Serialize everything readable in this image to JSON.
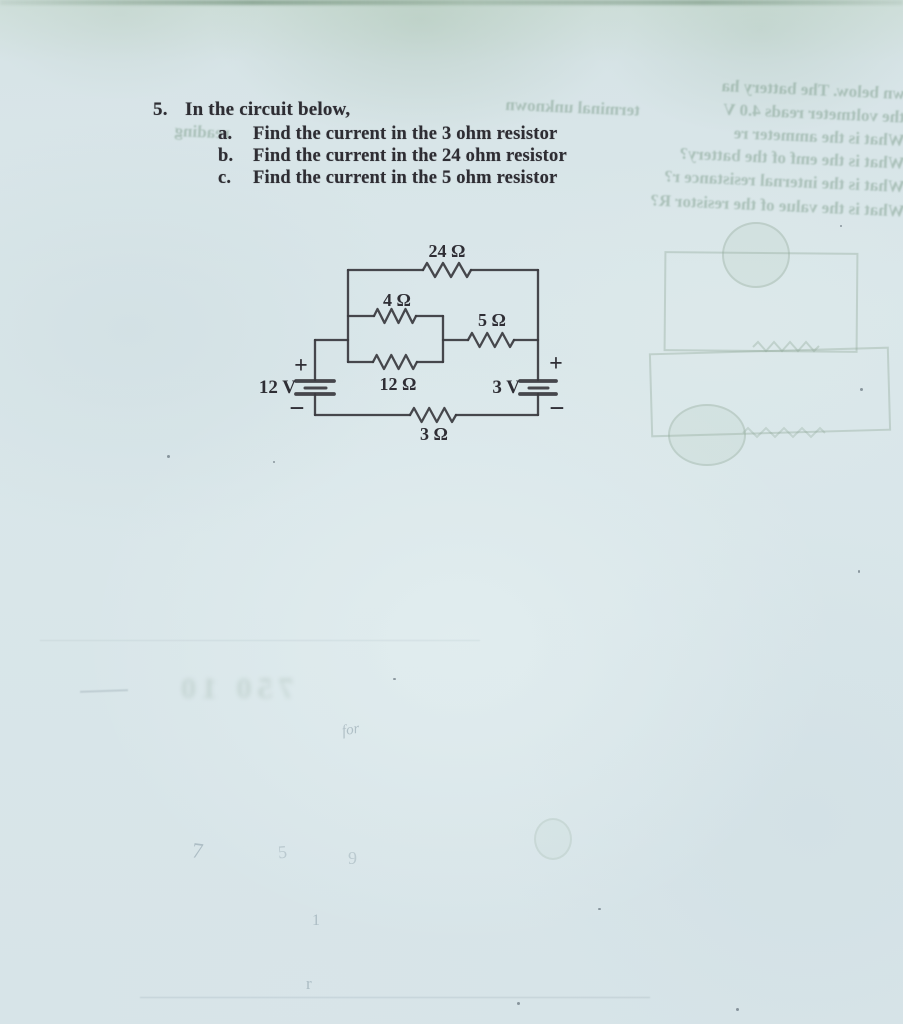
{
  "problem": {
    "number": "5.",
    "intro": "In the circuit below,",
    "items": [
      {
        "label": "a.",
        "text": "Find the current in the 3 ohm resistor"
      },
      {
        "label": "b.",
        "text": "Find the current in the 24 ohm resistor"
      },
      {
        "label": "c.",
        "text": "Find the current in the 5 ohm resistor"
      }
    ]
  },
  "circuit": {
    "r24": "24 Ω",
    "r4": "4 Ω",
    "r5": "5 Ω",
    "r12": "12 Ω",
    "r3": "3 Ω",
    "v_left": "12 V",
    "v_right": "3 V",
    "plus": "+",
    "minus": "−"
  },
  "ghost": {
    "lines": [
      {
        "text": "wn below. The battery ha"
      },
      {
        "text": "the voltmeter reads 4.0 V"
      },
      {
        "text": "What is the ammeter re"
      },
      {
        "text": "What is the emf of the battery?"
      },
      {
        "text": "What is the internal resistance r?"
      },
      {
        "text": "What is the value of the resistor R?"
      },
      {
        "text": "terminal unknown"
      },
      {
        "text": "reading"
      },
      {
        "text": "750 10"
      }
    ],
    "pencil": [
      "7",
      "5",
      "9",
      "1",
      "r",
      "for"
    ]
  },
  "colors": {
    "paper": "#d8e5e8",
    "ink": "#3a3a40",
    "bleedthrough_green": "#7c9b8a"
  }
}
